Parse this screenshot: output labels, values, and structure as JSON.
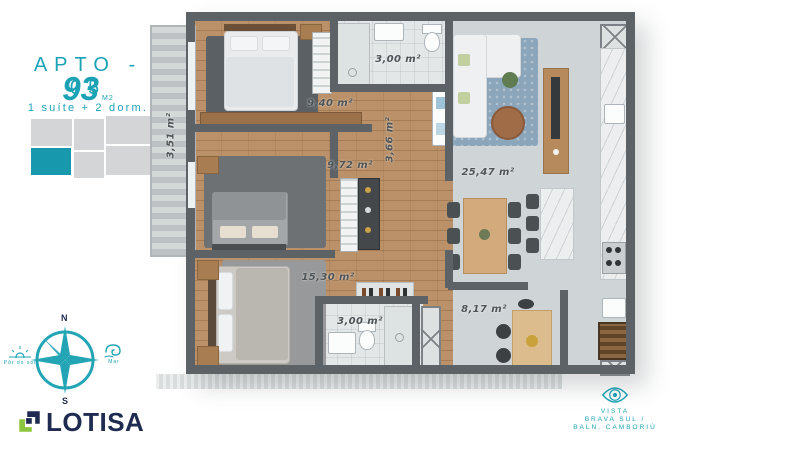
{
  "header": {
    "apto_label": "APTO - 05",
    "area_value": "93",
    "area_unit": "M2",
    "config": "1 suíte + 2 dorm."
  },
  "compass": {
    "north": "N",
    "south": "S",
    "sunset_label": "Pôr do sol",
    "sea_label": "Mar"
  },
  "brand": {
    "name": "LOTISA"
  },
  "view_note": {
    "line1": "VISTA",
    "line2": "BRAVA SUL /",
    "line3": "BALN. CAMBORIÚ"
  },
  "rooms": {
    "balcony": {
      "area": "3,51 m²"
    },
    "bath_top": {
      "area": "3,00 m²"
    },
    "hall_940": {
      "area": "9,40 m²"
    },
    "hall_366": {
      "area": "3,66 m²"
    },
    "hall_972": {
      "area": "9,72 m²"
    },
    "living": {
      "area": "25,47 m²"
    },
    "suite": {
      "area": "15,30 m²"
    },
    "bath_suite": {
      "area": "3,00 m²"
    },
    "terrace": {
      "area": "8,17 m²"
    }
  },
  "colors": {
    "accent_teal": "#1ba3b5",
    "brand_navy": "#1f2b50",
    "logo_green": "#8cc63f",
    "keyplan_highlight": "#1898ac",
    "wall_gray": "#5d6266",
    "wood_floor": "#b5895e",
    "tile_gray": "#cfd4d6",
    "rug_blue": "#8ba6bb",
    "label_gray": "#4e5457"
  }
}
